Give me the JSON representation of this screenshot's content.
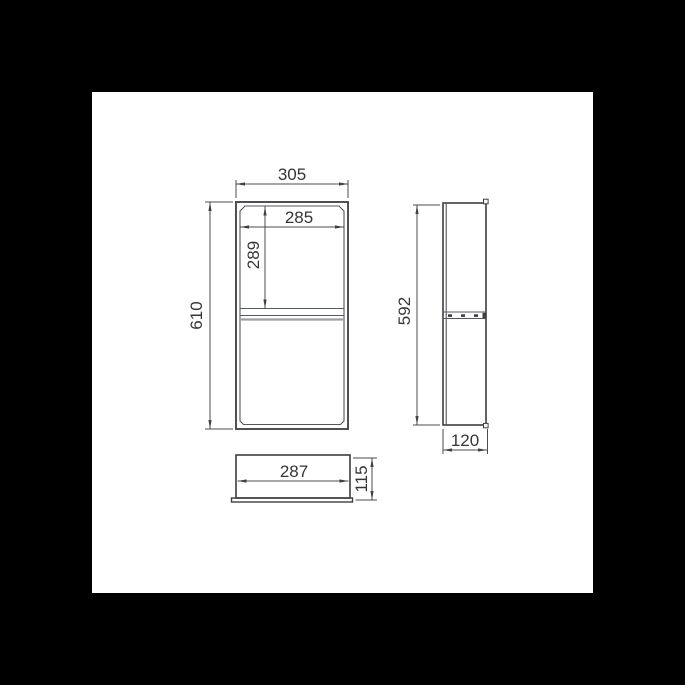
{
  "drawing": {
    "type": "technical-dimension-drawing",
    "subject": "double shower niche box, three orthographic views",
    "units": "mm"
  },
  "views": {
    "front": {
      "label": "front view",
      "outer_width_mm": "305",
      "inner_width_mm": "285",
      "upper_compartment_height_mm": "289",
      "outer_height_mm": "610"
    },
    "side": {
      "label": "side view",
      "height_mm": "592",
      "depth_mm": "120"
    },
    "bottom": {
      "label": "bottom view",
      "inner_width_mm": "287",
      "depth_mm": "115"
    }
  },
  "colors": {
    "background": "#000000",
    "paper": "#ffffff",
    "outline": "#3c3e42",
    "dimension_line": "#4a4c50",
    "text": "#353535",
    "shelf_edge_gray": "#9aa0a6"
  }
}
